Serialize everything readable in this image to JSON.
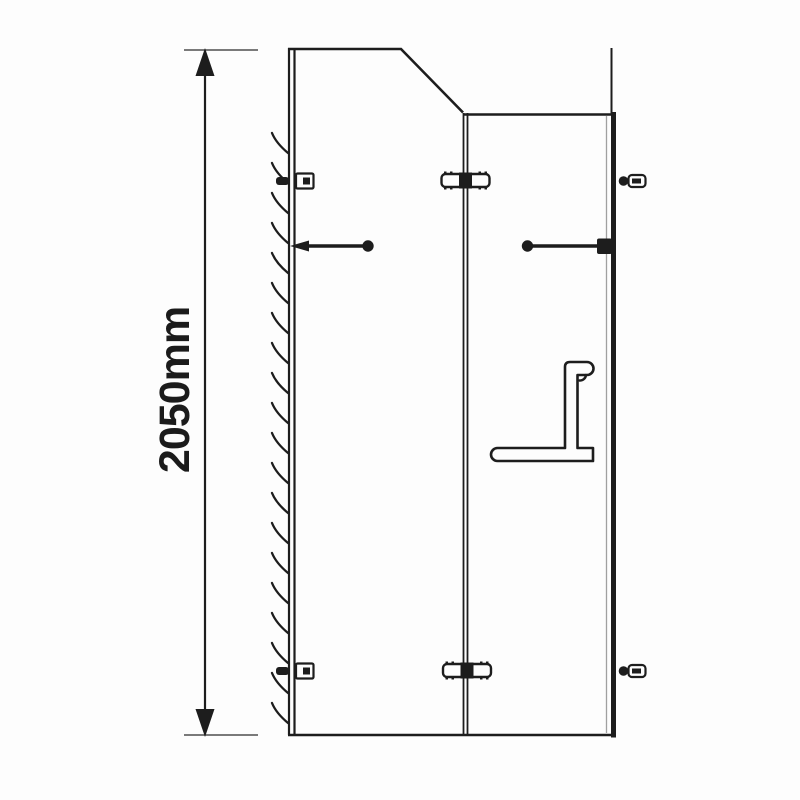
{
  "page": {
    "background_color": "#fdfdfd",
    "ink_color": "#1d1d1d",
    "secondary_line_color": "#4e4e4e"
  },
  "diagram": {
    "type": "technical-line-drawing",
    "subject": "shower-enclosure-side-elevation",
    "dimension": {
      "label": "2050mm",
      "value_mm": 2050,
      "orientation": "vertical"
    },
    "components": [
      {
        "name": "height-dimension-line"
      },
      {
        "name": "wall-with-hatching"
      },
      {
        "name": "fixed-panel-with-sloped-top"
      },
      {
        "name": "door-panel"
      },
      {
        "name": "side-panel-edge"
      },
      {
        "name": "wall-bracket",
        "count": 2
      },
      {
        "name": "glass-clamp",
        "count": 2
      },
      {
        "name": "panel-clamp",
        "count": 2
      },
      {
        "name": "support-bar-with-ball-end",
        "count": 2
      },
      {
        "name": "towel-bar-handle"
      },
      {
        "name": "floor-line"
      }
    ]
  }
}
